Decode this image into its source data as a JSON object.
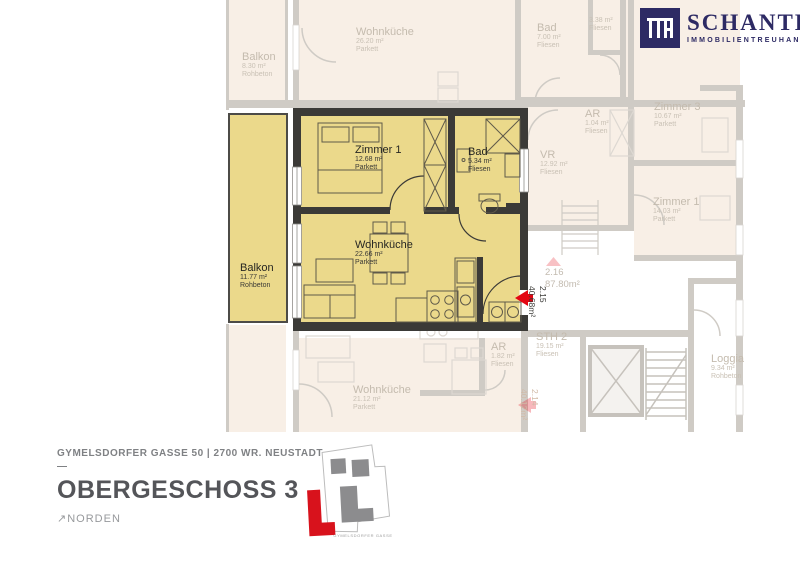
{
  "brand": {
    "monogram": "ITH",
    "name": "SCHANTL",
    "tagline": "IMMOBILIENTREUHAND",
    "color": "#2d2a64"
  },
  "apartment": {
    "unit": {
      "number": "2.15",
      "area": "40.68m²"
    },
    "rooms": [
      {
        "name": "Zimmer 1",
        "area": "12.68 m²",
        "floor": "Parkett"
      },
      {
        "name": "Bad",
        "area": "5.34 m²",
        "floor": "Fliesen"
      },
      {
        "name": "Wohnküche",
        "area": "22.66 m²",
        "floor": "Parkett"
      },
      {
        "name": "Balkon",
        "area": "11.77 m²",
        "floor": "Rohbeton"
      }
    ],
    "highlight_color": "#ebd98b",
    "wall_color": "#3b3a37",
    "entry_arrow_color": "#e30613"
  },
  "background_plan": {
    "rooms": [
      {
        "name": "Balkon",
        "area": "8.30 m²",
        "floor": "Rohbeton"
      },
      {
        "name": "Wohnküche",
        "area": "26.20 m²",
        "floor": "Parkett"
      },
      {
        "name": "Bad",
        "area": "7.00 m²",
        "floor": "Fliesen"
      },
      {
        "name": "",
        "area": "3.38 m²",
        "floor": "Fliesen"
      },
      {
        "name": "AR",
        "area": "1.04 m²",
        "floor": "Fliesen"
      },
      {
        "name": "Zimmer 3",
        "area": "10.67 m²",
        "floor": "Parkett"
      },
      {
        "name": "VR",
        "area": "12.92 m²",
        "floor": "Fliesen"
      },
      {
        "name": "Zimmer 1",
        "area": "14.03 m²",
        "floor": "Parkett"
      },
      {
        "name": "STH 2",
        "area": "19.15 m²",
        "floor": "Fliesen"
      },
      {
        "name": "Wohnküche",
        "area": "21.12 m²",
        "floor": "Parkett"
      },
      {
        "name": "AR",
        "area": "1.82 m²",
        "floor": "Fliesen"
      },
      {
        "name": "Loggia",
        "area": "9.34 m²",
        "floor": "Rohbeton"
      }
    ],
    "units": [
      {
        "number": "2.16",
        "area": "87.80m²"
      },
      {
        "number": "2.14",
        "area": "40.12m²"
      }
    ]
  },
  "footer": {
    "address": "GYMELSDORFER GASSE 50 | 2700 WR. NEUSTADT",
    "divider": "—",
    "title": "OBERGESCHOSS 3",
    "north_arrow": "↗",
    "north_label": "NORDEN",
    "site_logo_caption": "GYMELSDORFER GASSE"
  }
}
